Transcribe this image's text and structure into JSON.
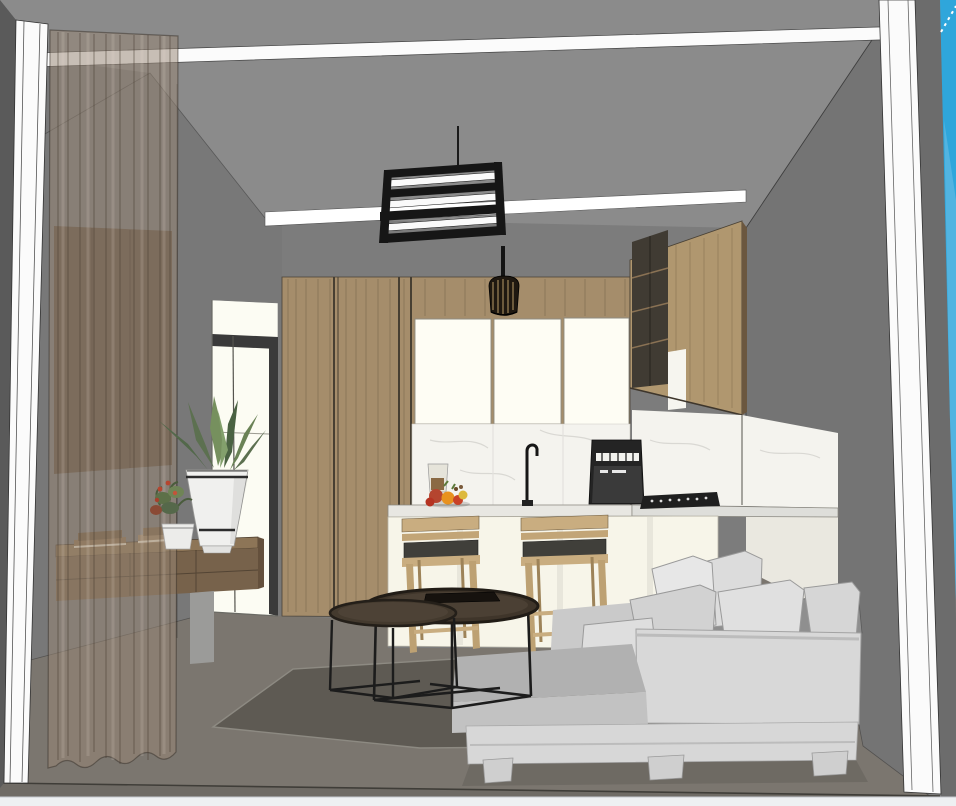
{
  "viewport": {
    "kind": "3d-interior-render-viewport",
    "description": "SketchUp-style textured render with edges: open-plan living room and kitchen seen through a window wall",
    "width": 956,
    "height": 806
  },
  "scene": {
    "objects": [
      "window-frame-mullions",
      "sky",
      "ceiling-light-cove",
      "ceiling-tray",
      "rect-pendant-light",
      "mini-pendant-lamp",
      "sheer-curtain",
      "tv-wall-panel",
      "floating-console",
      "book-stacks",
      "snake-plant-in-white-vase",
      "small-potted-plant",
      "glass-entry-door",
      "tall-wood-cabinets",
      "kitchen-upper-cabinets",
      "marble-backsplash",
      "kitchen-faucet",
      "coffee-machine",
      "gas-cooktop",
      "fruit-bowl",
      "bar-counter",
      "two-bar-stools",
      "nesting-coffee-tables",
      "sectional-sofa",
      "throw-pillows",
      "area-rug"
    ]
  },
  "palette": {
    "wall_back": "#7c7c7c",
    "wall_left": "#787878",
    "wall_right": "#747474",
    "wall_outer": "#6c6c6c",
    "wall_edge_dark": "#5a5a5a",
    "ceiling": "#8b8b8b",
    "sky": "#2fa6db",
    "sky_light": "#6fc0e6",
    "frame_white": "#fbfbfb",
    "cove_white": "#ffffff",
    "floor": "#7b766f",
    "floor_front": "#6f6b65",
    "rug": "#5e5a53",
    "door_glow": "#fcfcf3",
    "door_frame": "#3a3a3a",
    "tv_panel": "#5f5142",
    "curtain": "rgba(152,134,116,0.52)",
    "console_top": "#8d7557",
    "console_front": "#77624b",
    "wood_cabinet": "#a58d6b",
    "wood_cabinet_right": "#b0976f",
    "wood_side": "#6b573f",
    "shelf_dark": "#403b33",
    "cabinet_white": "#fefdf4",
    "marble": "#f4f3ee",
    "counter": "#e8e7e2",
    "island_front": "#f7f5e9",
    "base_cabinet": "#eae8e0",
    "appliance_black": "#242424",
    "vase": "#f0f0ee",
    "leaf_green": "#5c7050",
    "flower_red": "#b5452f",
    "stool_wood": "#c9ad80",
    "stool_cushion": "#403f3a",
    "table_top": "#3f352a",
    "metal_black": "#1c1c1c",
    "sofa_light": "#d8d8d8",
    "sofa_seat": "#b1b1b1",
    "sofa_dark": "#8f8f8f",
    "pillow": "#e7e7e7",
    "bottom_bar": "#eef0f2"
  }
}
